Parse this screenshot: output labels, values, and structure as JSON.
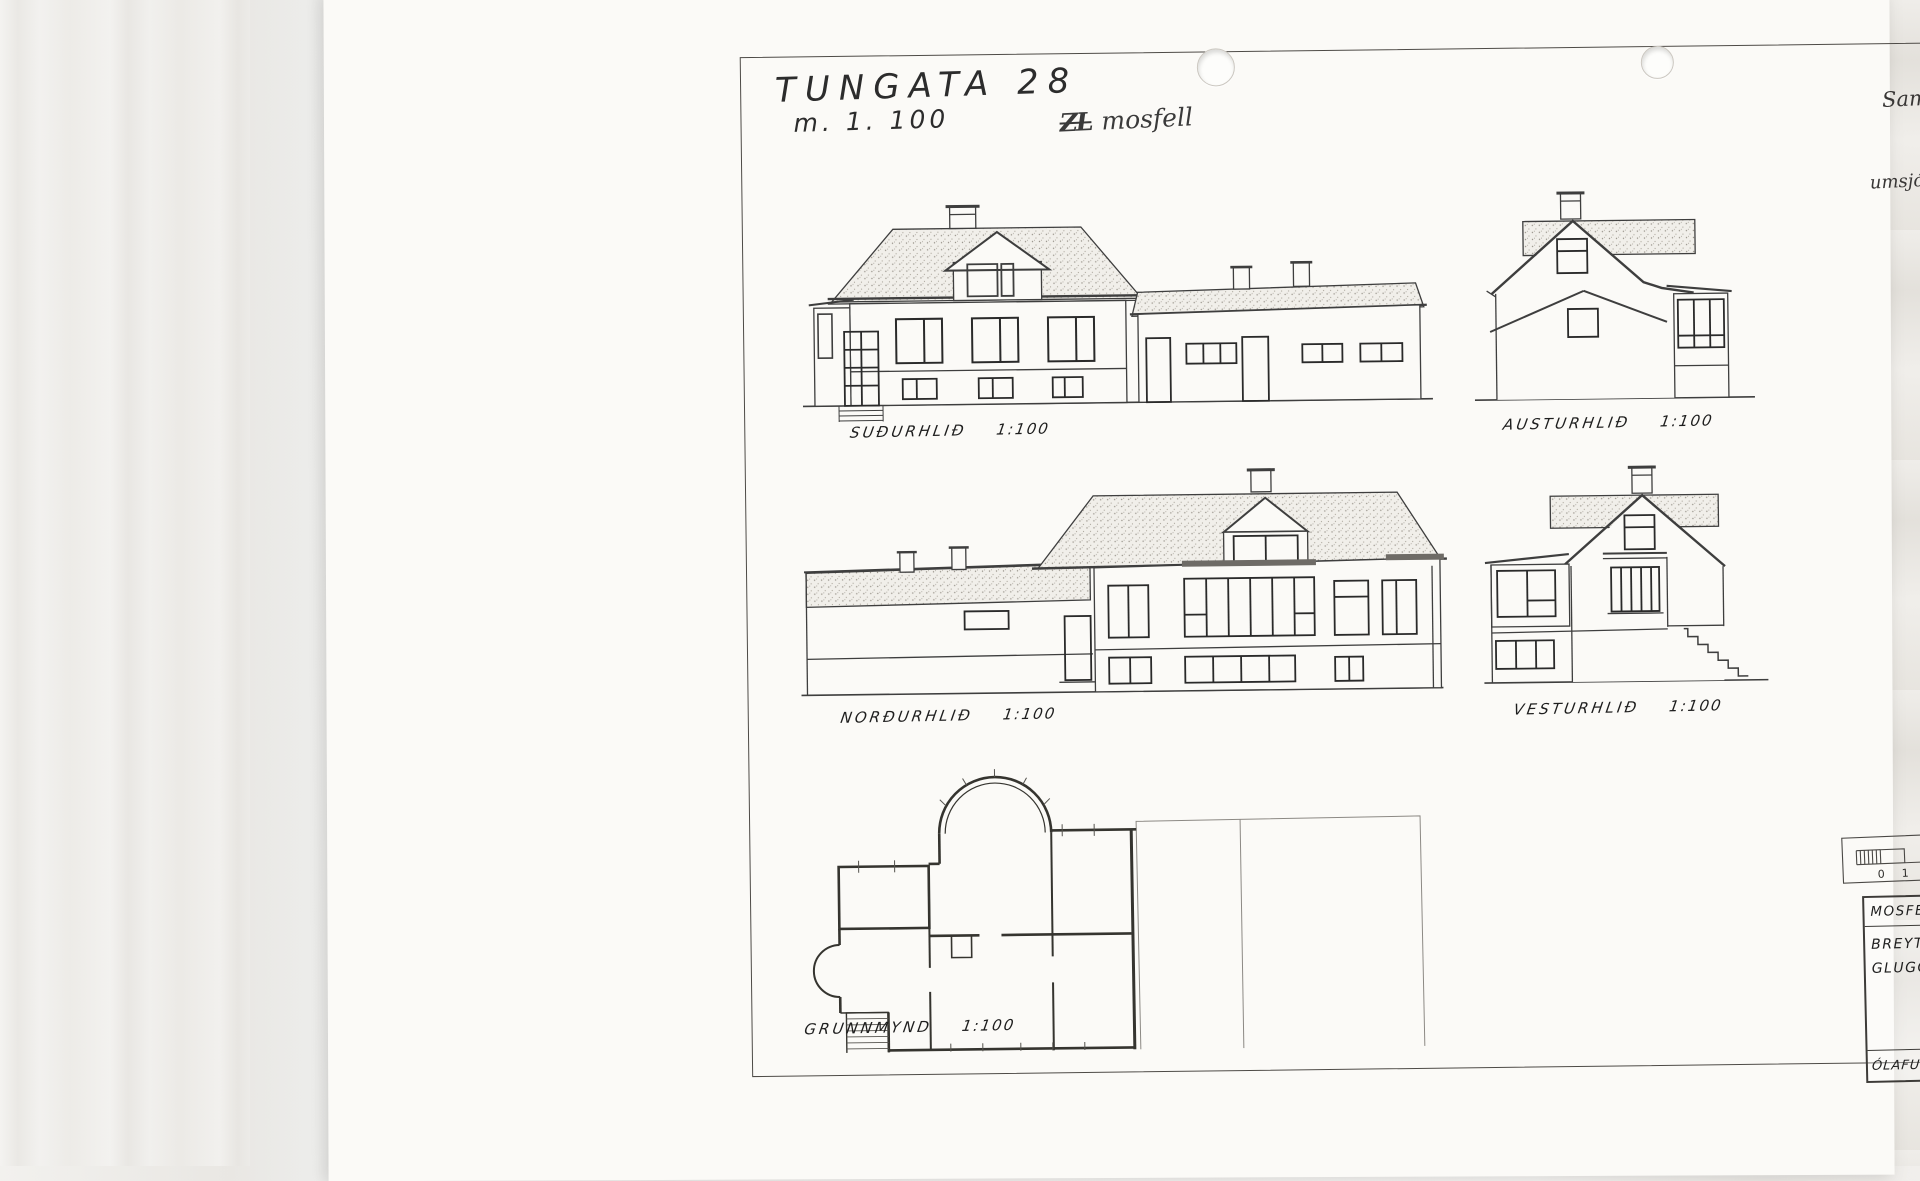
{
  "page": {
    "annotations": {
      "title": "TUNGATA 28",
      "scale_note": "m. 1. 100",
      "crossed_initials": "ZL",
      "location_note": "mosfell",
      "approval_line1": "Samþ. í byggingarn.",
      "approval_line2": "11 - 7 - '72",
      "approval_line3": "umsjón.m. Egill Kristjánsson",
      "stamp_digits": [
        "1",
        "3",
        "3",
        "2"
      ]
    },
    "drawings": [
      {
        "id": "south",
        "label": "SUÐURHLIÐ",
        "scale": "1:100"
      },
      {
        "id": "east",
        "label": "AUSTURHLIÐ",
        "scale": "1:100"
      },
      {
        "id": "north",
        "label": "NORÐURHLIÐ",
        "scale": "1:100"
      },
      {
        "id": "west",
        "label": "VESTURHLIÐ",
        "scale": "1:100"
      },
      {
        "id": "plan",
        "label": "GRUNNMYND",
        "scale": "1:100"
      }
    ],
    "scale_bar": {
      "ticks": [
        "0",
        "1",
        "2",
        "3",
        "4",
        "5",
        "6",
        "7",
        "8"
      ]
    },
    "title_block": {
      "project": "MOSFELL / EIRÍKUR SIGURÐSSON",
      "subject_line1": "BREYTING Á",
      "subject_line2": "GLUGGAPÓSTUM",
      "date_label": "DAGS.",
      "date_value": "20.1. 1972",
      "scale_label": "MKV.",
      "scale_value": "1:100",
      "signature": "ÓlG",
      "number_label": "NR.",
      "number_value": "1",
      "engineer": "ÓLAFUR GUNNARSSON VERKFRÆÐINGUR"
    },
    "colors": {
      "ink": "#3e3e3e",
      "paper": "#fbfaf7",
      "stamp_ink": "#101010"
    }
  }
}
